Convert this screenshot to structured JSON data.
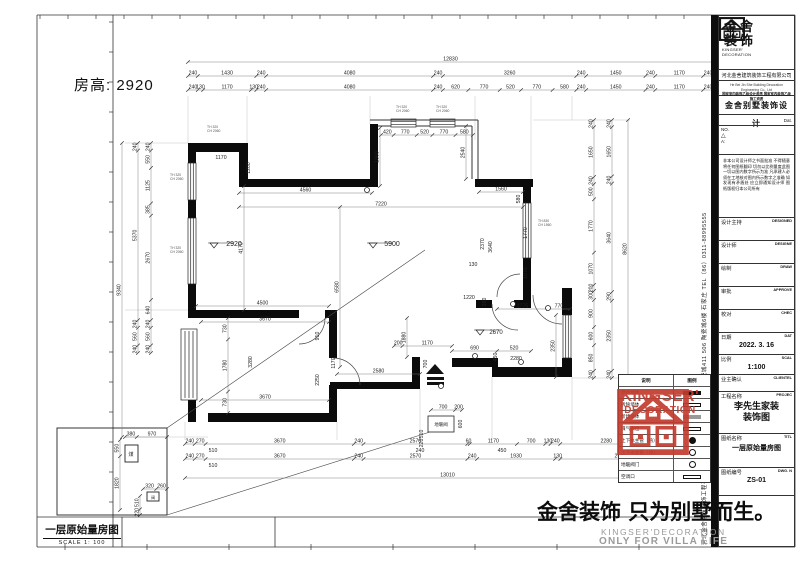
{
  "sheet": {
    "room_height_note": "房高: 2920"
  },
  "strip": {
    "title": "一层原始量房图",
    "scale": "SCALE 1: 100"
  },
  "watermark": {
    "cn": "金舍装饰 只为别墅而生。",
    "en1": "KINGSER'DECORATION",
    "en2": "ONLY FOR VILLA LIFE"
  },
  "stamp": {
    "brand": "KINGSER'",
    "sub": "DECORATION"
  },
  "side_text": "河北金舍建筑装饰工程有限公司  河北省石家庄市裕华区怀特陶瓷城411 506 陶瓷城6楼    石家庄 TEL（86）0311-88995555",
  "titleblock": {
    "brand_cn1": "金舍",
    "brand_cn2": "装饰",
    "brand_en1": "KINGSER'",
    "brand_en2": "DECORATION",
    "company": "河北金舍建筑装饰工程有限公司",
    "company_en": "He Bei Jin She Building Decoration Engineering Co., Ltd",
    "tagline": "国家室内装饰乙级设计资质 国家室内装饰乙级施工资质",
    "design_title": "金舍别墅装饰设计",
    "date_small": "Dat.",
    "no_label": "NO.",
    "tri": "△",
    "a_label": "A:",
    "disclaimer": "非本公司设计师之书面批准 不得随意将任何图纸翻印 切勿以比例量度此图 一切以图内数字所示为准 凡承建人必须在工地核对图内所示数字之准确 如发现有矛盾处 应立即通知设计师 图纸版权归本公司所有",
    "rows": [
      {
        "cn": "设计主持",
        "en": "DESIGNED",
        "val": ""
      },
      {
        "cn": "设计师",
        "en": "DESIGNE",
        "val": ""
      },
      {
        "cn": "绘制",
        "en": "DRAW",
        "val": ""
      },
      {
        "cn": "审批",
        "en": "APPROVE",
        "val": ""
      },
      {
        "cn": "校对",
        "en": "CHEC",
        "val": ""
      },
      {
        "cn": "日期",
        "en": "DAT",
        "val": "2022. 3. 16",
        "cls": "med"
      },
      {
        "cn": "比例",
        "en": "SCAL",
        "val": "1:100",
        "cls": "med"
      },
      {
        "cn": "业主确认",
        "en": "CLIENTEL",
        "val": ""
      },
      {
        "cn": "工程名称",
        "en": "PROJEC",
        "val": "李先生家装\n装饰图",
        "cls": "big"
      },
      {
        "cn": "图纸名称",
        "en": "TITL",
        "val": "一层原始量房图",
        "cls": "med"
      },
      {
        "cn": "图纸编号",
        "en": "DWG. N",
        "val": "ZS-01",
        "cls": "med"
      }
    ]
  },
  "legend": {
    "headers": [
      "说明",
      "图例"
    ],
    "rows": [
      {
        "label": "原始墙体",
        "sym": "fill"
      },
      {
        "label": "拆除墙体",
        "sym": "open"
      },
      {
        "label": "新建墙体",
        "sym": "gray"
      },
      {
        "label": "煤气表位",
        "sym": "open"
      },
      {
        "label": "上下水主管（热）",
        "sym": "circf"
      },
      {
        "label": "上下水主管（冷）",
        "sym": "circ"
      },
      {
        "label": "地暖阀门",
        "sym": "circ"
      },
      {
        "label": "空调口",
        "sym": "open"
      }
    ]
  },
  "plan": {
    "chains": [
      {
        "d": "h",
        "x0": 188,
        "x1": 713,
        "y": 62,
        "v": [
          12830
        ]
      },
      {
        "d": "h",
        "x0": 188,
        "x1": 713,
        "y": 76,
        "v": [
          240,
          1430,
          240,
          4080,
          240,
          3260,
          240,
          1450,
          240,
          1170,
          240
        ]
      },
      {
        "d": "h",
        "x0": 188,
        "x1": 713,
        "y": 90,
        "v": [
          240,
          130,
          1170,
          130,
          240,
          4080,
          240,
          620,
          770,
          520,
          770,
          580,
          240,
          1450,
          240,
          1170,
          240
        ]
      },
      {
        "d": "h",
        "x0": 185,
        "x1": 662,
        "y": 444,
        "v": [
          240,
          270,
          3670,
          240,
          2570,
          60,
          1170,
          700,
          130,
          240,
          2280,
          240
        ]
      },
      {
        "d": "h",
        "x0": 185,
        "x1": 690,
        "y": 459,
        "v": [
          240,
          270,
          3670,
          240,
          2570,
          240,
          1930,
          130,
          2970,
          240
        ]
      },
      {
        "d": "h",
        "x0": 185,
        "x1": 710,
        "y": 478,
        "v": [
          13010
        ]
      },
      {
        "d": "v",
        "x": 122,
        "y0": 143,
        "y1": 437,
        "v": [
          9340
        ]
      },
      {
        "d": "v",
        "x": 138,
        "y0": 143,
        "y1": 353,
        "v": [
          240,
          5370,
          240,
          560,
          240
        ]
      },
      {
        "d": "v",
        "x": 151,
        "y0": 143,
        "y1": 353,
        "v": [
          240,
          550,
          1125,
          385,
          2670,
          640,
          240,
          560,
          240
        ]
      },
      {
        "d": "v",
        "x": 628,
        "y0": 120,
        "y1": 378,
        "v": [
          8620
        ]
      },
      {
        "d": "v",
        "x": 612,
        "y0": 120,
        "y1": 378,
        "v": [
          240,
          1650,
          240,
          3640,
          290,
          2350,
          240
        ]
      },
      {
        "d": "v",
        "x": 594,
        "y0": 120,
        "y1": 378,
        "v": [
          240,
          1650,
          240,
          500,
          1770,
          1070,
          200,
          300,
          900,
          600,
          850,
          240
        ]
      },
      {
        "d": "h",
        "x0": 239,
        "x1": 523,
        "y": 207,
        "v": [
          7220
        ]
      },
      {
        "d": "h",
        "x0": 239,
        "x1": 372,
        "y": 193,
        "v": [
          4560
        ]
      },
      {
        "d": "h",
        "x0": 196,
        "x1": 329,
        "y": 306,
        "v": [
          4500
        ]
      },
      {
        "d": "h",
        "x0": 201,
        "x1": 329,
        "y": 322,
        "v": [
          3670
        ]
      },
      {
        "d": "h",
        "x0": 201,
        "x1": 329,
        "y": 400,
        "v": [
          3670
        ]
      },
      {
        "d": "h",
        "x0": 337,
        "x1": 420,
        "y": 374,
        "v": [
          2580
        ]
      },
      {
        "d": "h",
        "x0": 381,
        "x1": 473,
        "y": 135,
        "v": [
          420,
          770,
          520,
          770,
          580
        ]
      },
      {
        "d": "h",
        "x0": 479,
        "x1": 523,
        "y": 192,
        "v": [
          1560
        ]
      },
      {
        "d": "h",
        "x0": 394,
        "x1": 452,
        "y": 346,
        "v": [
          200,
          1170
        ]
      },
      {
        "d": "h",
        "x0": 452,
        "x1": 531,
        "y": 351,
        "v": [
          690,
          520
        ]
      },
      {
        "d": "h",
        "x0": 497,
        "x1": 570,
        "y": 309,
        "v": [
          1775,
          770
        ]
      },
      {
        "d": "h",
        "x0": 431,
        "x1": 462,
        "y": 410,
        "v": [
          700,
          200
        ]
      },
      {
        "d": "v",
        "x": 244,
        "y0": 186,
        "y1": 310,
        "v": [
          4170
        ]
      },
      {
        "d": "v",
        "x": 228,
        "y0": 318,
        "y1": 413,
        "v": [
          730,
          1780,
          730
        ]
      },
      {
        "d": "v",
        "x": 340,
        "y0": 207,
        "y1": 367,
        "v": [
          6580
        ]
      },
      {
        "d": "v",
        "x": 380,
        "y0": 128,
        "y1": 186,
        "v": [
          1860
        ]
      },
      {
        "d": "v",
        "x": 466,
        "y0": 126,
        "y1": 179,
        "v": [
          2540
        ]
      },
      {
        "d": "v",
        "x": 556,
        "y0": 315,
        "y1": 377,
        "v": [
          2350
        ]
      },
      {
        "d": "v",
        "x": 407,
        "y0": 318,
        "y1": 357,
        "v": [
          1880
        ]
      },
      {
        "d": "h",
        "x0": 125,
        "x1": 167,
        "y": 437,
        "v": [
          380,
          970
        ]
      },
      {
        "d": "v",
        "x": 120,
        "y0": 440,
        "y1": 510,
        "v": [
          550,
          1820
        ]
      },
      {
        "d": "h",
        "x0": 143,
        "x1": 167,
        "y": 489,
        "v": [
          320,
          260
        ]
      },
      {
        "d": "v",
        "x": 140,
        "y0": 496,
        "y1": 515,
        "v": [
          510,
          220
        ]
      }
    ],
    "labels": [
      {
        "t": "1170",
        "x": 221,
        "y": 159
      },
      {
        "t": "1200",
        "x": 250,
        "y": 168,
        "r": 1
      },
      {
        "t": "2920",
        "x": 234,
        "y": 246,
        "s": 7
      },
      {
        "t": "5900",
        "x": 392,
        "y": 246,
        "s": 7
      },
      {
        "t": "2670",
        "x": 496,
        "y": 334,
        "s": 6
      },
      {
        "t": "3280",
        "x": 252,
        "y": 362,
        "r": 1
      },
      {
        "t": "910",
        "x": 319,
        "y": 336,
        "r": 1
      },
      {
        "t": "1170",
        "x": 335,
        "y": 363,
        "r": 1
      },
      {
        "t": "2250",
        "x": 319,
        "y": 380,
        "r": 1
      },
      {
        "t": "580",
        "x": 520,
        "y": 199,
        "r": 1
      },
      {
        "t": "2370",
        "x": 484,
        "y": 244,
        "r": 1
      },
      {
        "t": "3640",
        "x": 492,
        "y": 247,
        "r": 1
      },
      {
        "t": "1770",
        "x": 527,
        "y": 233,
        "r": 1
      },
      {
        "t": "1070",
        "x": 527,
        "y": 273,
        "r": 1
      },
      {
        "t": "1220",
        "x": 469,
        "y": 299
      },
      {
        "t": "360",
        "x": 486,
        "y": 302,
        "r": 1
      },
      {
        "t": "130",
        "x": 473,
        "y": 266
      },
      {
        "t": "700",
        "x": 427,
        "y": 364,
        "r": 1
      },
      {
        "t": "2280",
        "x": 516,
        "y": 360
      },
      {
        "t": "450",
        "x": 497,
        "y": 357,
        "r": 1
      },
      {
        "t": "510",
        "x": 213,
        "y": 452
      },
      {
        "t": "240",
        "x": 420,
        "y": 452
      },
      {
        "t": "450",
        "x": 502,
        "y": 452
      },
      {
        "t": "510",
        "x": 213,
        "y": 467
      },
      {
        "t": "600",
        "x": 462,
        "y": 424,
        "r": 1
      },
      {
        "t": "510",
        "x": 423,
        "y": 434,
        "r": 1
      },
      {
        "t": "220",
        "x": 423,
        "y": 443,
        "r": 1
      },
      {
        "t": "地暖阀",
        "x": 441,
        "y": 426,
        "s": 4.5
      },
      {
        "t": "煤",
        "x": 131,
        "y": 456,
        "s": 5
      },
      {
        "t": "阀",
        "x": 153,
        "y": 499,
        "s": 4
      }
    ],
    "window_notes": [
      {
        "l1": "TH 320",
        "l2": "CH 2060",
        "x": 207,
        "y": 128
      },
      {
        "l1": "TH 320",
        "l2": "CH 2060",
        "x": 396,
        "y": 108
      },
      {
        "l1": "TH 320",
        "l2": "CH 2060",
        "x": 436,
        "y": 108
      },
      {
        "l1": "TH 320",
        "l2": "CH 2060",
        "x": 170,
        "y": 176
      },
      {
        "l1": "TH 320",
        "l2": "CH 2060",
        "x": 170,
        "y": 249
      },
      {
        "l1": "TH 830",
        "l2": "CH 1560",
        "x": 538,
        "y": 222
      }
    ],
    "level_marks": [
      {
        "x": 214,
        "y": 246
      },
      {
        "x": 373,
        "y": 246
      },
      {
        "x": 480,
        "y": 333
      }
    ],
    "pipes": [
      {
        "x": 367,
        "y": 190
      },
      {
        "x": 513,
        "y": 304
      },
      {
        "x": 548,
        "y": 308
      },
      {
        "x": 475,
        "y": 356
      },
      {
        "x": 441,
        "y": 386
      },
      {
        "x": 521,
        "y": 362
      }
    ]
  }
}
